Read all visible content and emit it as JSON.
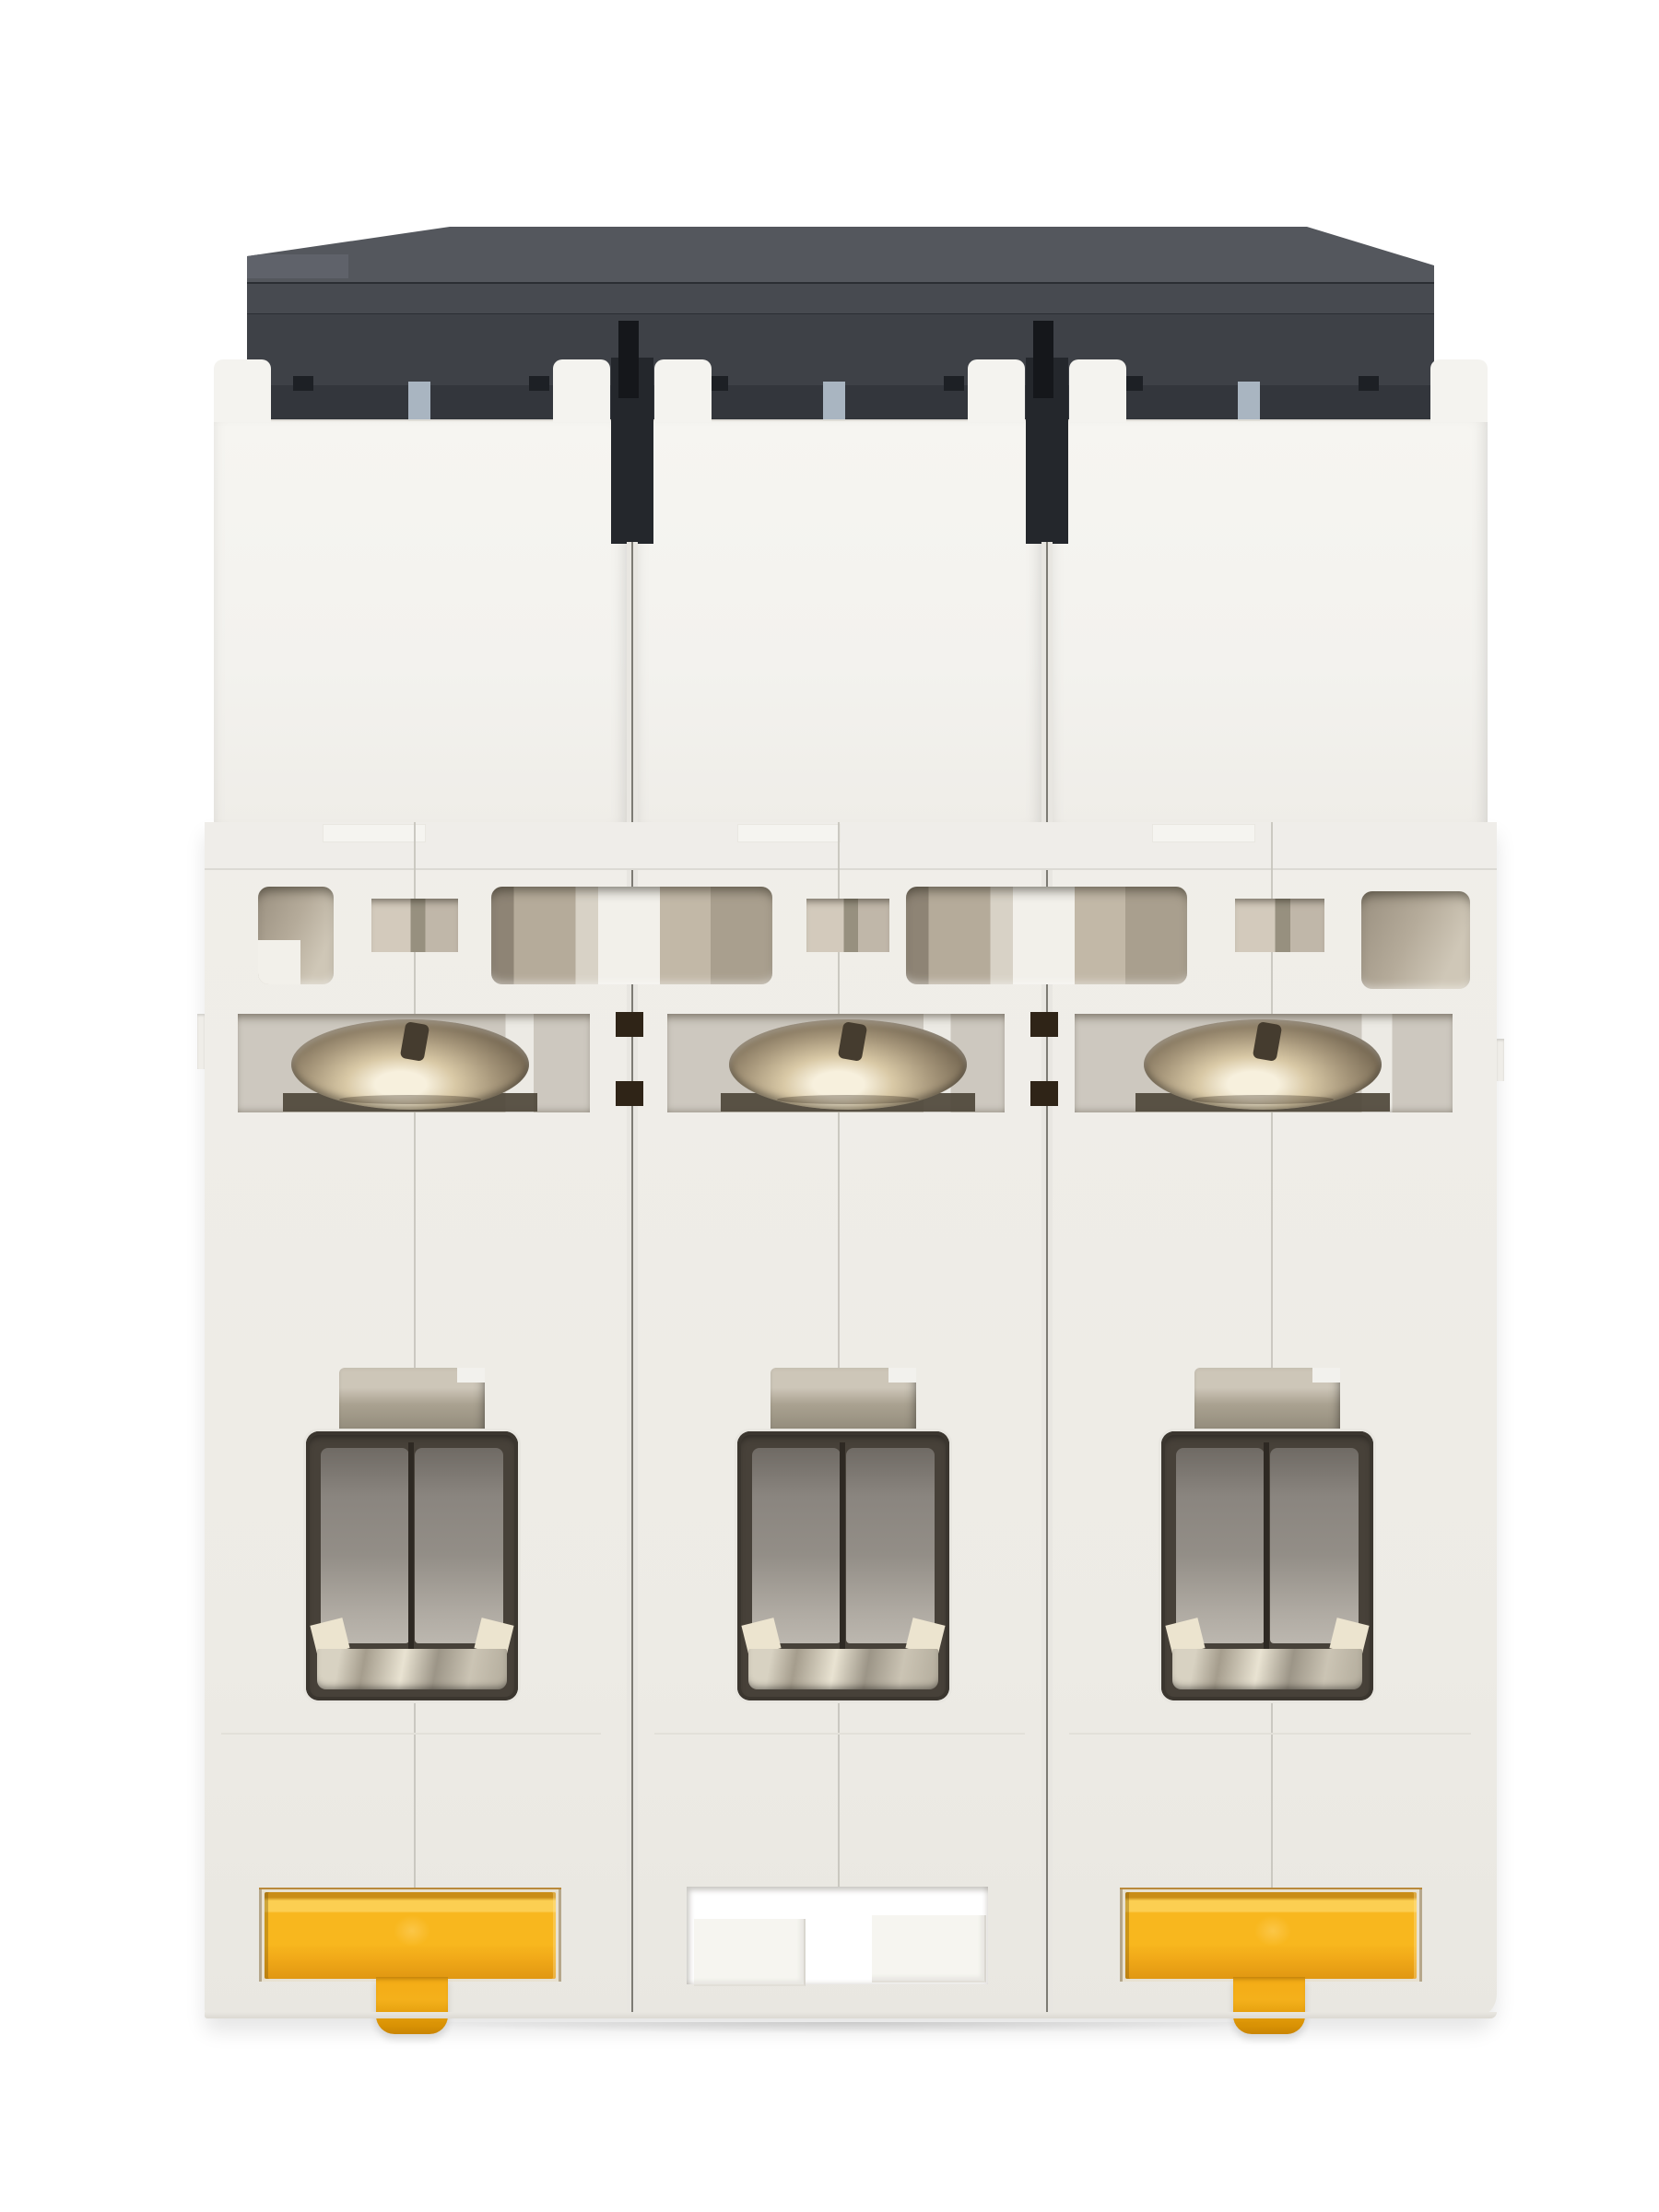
{
  "image_alt": "Rear bottom view of a white 3-pole DIN-rail miniature circuit breaker: dark charcoal top cover, three white pole modules with vent openings, three nickel pan-head terminal screws, three wire terminal cavities with metal clamps, yellow DIN-rail release clips on the outer poles and a rail notch on the middle pole",
  "scene": {
    "subject": "3-pole miniature circuit breaker (MCB), DIN-rail side",
    "pole_count": 3,
    "background": "plain white studio backdrop"
  },
  "parts": {
    "top_cover": "dark charcoal plastic cap with stepped profile",
    "modules": [
      "pole-1",
      "pole-2",
      "pole-3"
    ],
    "rail_spacer_tabs": "light blue-gray tab at the top of each pole",
    "vent_openings": "beige rectangular vent openings and small square ports",
    "terminal_screws": "nickel pan-head terminal screw in a recessed cavity, one per pole",
    "terminal_openings": "rectangular wire terminal cavities with metal clamp plates, one per pole",
    "din_clips": "yellow DIN-rail release clips on pole 1 and pole 3",
    "center_notch": "rail notch with two step blocks on pole 2"
  },
  "colors": {
    "bg": "#ffffff",
    "module": "#f4f3ef",
    "module-lo": "#efede8",
    "ledge": "#efede9",
    "edge-line": "#dcdad4",
    "seam": "#c6c4bd",
    "sep-groove": "#e8e6e1",
    "sep-line": "#7d7b74",
    "cap-1": "#54575d",
    "cap-2": "#474a50",
    "cap-3": "#3e4147",
    "cap-4": "#33363c",
    "cap-seam": "#2b2e33",
    "cap-hi": "#5f626a",
    "slot": "#24272c",
    "slot-deep": "#15171b",
    "notch-dark": "#1d2025",
    "tab-blue": "#a9b5c1",
    "vent-a": "#9a9080",
    "vent-b": "#b5ab9a",
    "vent-c": "#cfc7b7",
    "vent-white": "#f2f0ea",
    "sq-a": "#d3cabc",
    "sq-b": "#97907f",
    "sq-c": "#c0b7a9",
    "cav": "#cdc8bf",
    "screw-hi": "#f7f0dd",
    "screw-a": "#d9c9a6",
    "screw-b": "#a6967a",
    "screw-c": "#7a6c56",
    "screw-d": "#4e463a",
    "metal-a": "#c8c1b2",
    "metal-b": "#8f8878",
    "term-frame": "#474139",
    "term-panel": "#938e87",
    "term-panel-lo": "#b0aba3",
    "term-metal-a": "#d8d2c2",
    "term-metal-b": "#9c9587",
    "clip": "#f8b71e",
    "clip-hi": "#fccf52",
    "clip-lo": "#e09712",
    "clip-deep": "#c98d17",
    "notch-face": "#f6f5f0"
  }
}
